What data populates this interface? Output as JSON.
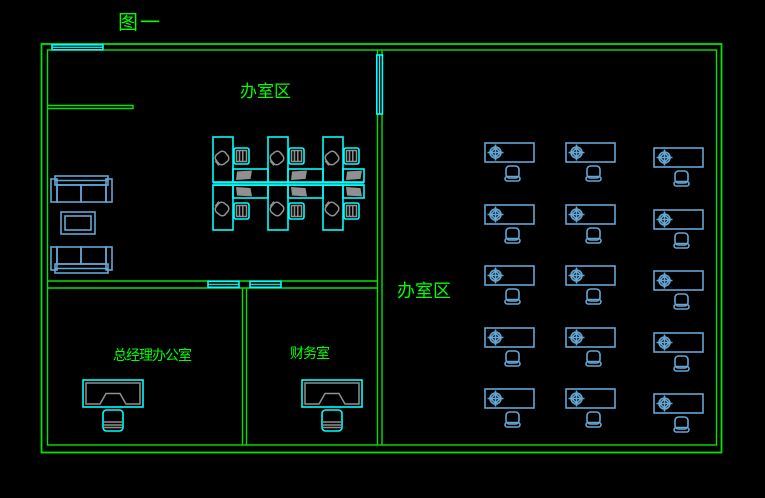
{
  "title": "图一",
  "colors": {
    "wall": "#00e400",
    "text": "#00ff00",
    "cyan": "#00ffff",
    "blue": "#64a6d2",
    "gray": "#909090"
  },
  "rooms": {
    "left_office": {
      "label": "办室区"
    },
    "right_office": {
      "label": "办室区"
    },
    "manager": {
      "label": "总经理办公室"
    },
    "finance": {
      "label": "财务室"
    }
  },
  "left_room": {
    "workstation_count": 6,
    "workstations": [
      {
        "x": 213,
        "row": "top",
        "dw": 35
      },
      {
        "x": 268,
        "row": "top",
        "dw": 35
      },
      {
        "x": 323,
        "row": "top",
        "dw": 21
      },
      {
        "x": 213,
        "row": "bottom",
        "dw": 35
      },
      {
        "x": 268,
        "row": "bottom",
        "dw": 35
      },
      {
        "x": 323,
        "row": "bottom",
        "dw": 21
      }
    ]
  },
  "right_room": {
    "desk_count": 15,
    "desks": [
      {
        "x": 485,
        "y": 143
      },
      {
        "x": 566,
        "y": 143
      },
      {
        "x": 654,
        "y": 148
      },
      {
        "x": 485,
        "y": 205
      },
      {
        "x": 566,
        "y": 205
      },
      {
        "x": 654,
        "y": 210
      },
      {
        "x": 485,
        "y": 266
      },
      {
        "x": 566,
        "y": 266
      },
      {
        "x": 654,
        "y": 271
      },
      {
        "x": 485,
        "y": 328
      },
      {
        "x": 566,
        "y": 328
      },
      {
        "x": 654,
        "y": 333
      },
      {
        "x": 485,
        "y": 389
      },
      {
        "x": 566,
        "y": 389
      },
      {
        "x": 654,
        "y": 394
      }
    ]
  }
}
